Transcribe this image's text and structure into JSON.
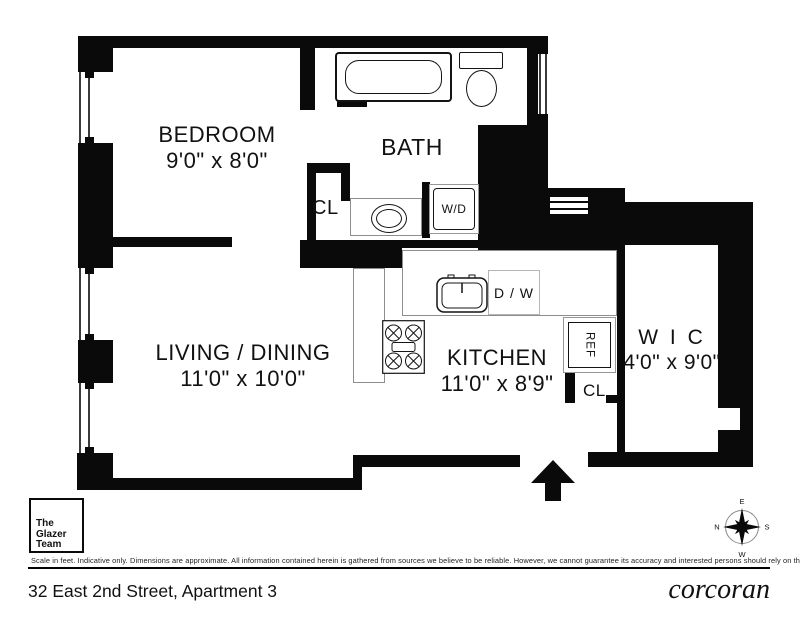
{
  "meta": {
    "address": "32 East 2nd Street, Apartment 3",
    "brand": "corcoran",
    "team": {
      "line1": "The",
      "line2": "Glazer",
      "line3": "Team"
    }
  },
  "disclaimer": "Scale in feet. Indicative only. Dimensions are approximate. All information contained herein is gathered from sources we believe to be reliable. However, we cannot guarantee its accuracy and interested persons should rely on their own enquiries.",
  "rooms": [
    {
      "id": "bedroom",
      "name": "BEDROOM",
      "dims": "9'0\" x 8'0\""
    },
    {
      "id": "bath",
      "name": "BATH",
      "dims": ""
    },
    {
      "id": "living-dining",
      "name": "LIVING / DINING",
      "dims": "11'0\" x 10'0\""
    },
    {
      "id": "kitchen",
      "name": "KITCHEN",
      "dims": "11'0\" x 8'9\""
    },
    {
      "id": "walk-in-closet",
      "name": "W I C",
      "dims": "4'0\" x 9'0\""
    },
    {
      "id": "closet-bath",
      "name": "CL"
    },
    {
      "id": "closet-entry",
      "name": "CL"
    }
  ],
  "fixtures": {
    "washer_dryer": "W/D",
    "dishwasher": "D / W",
    "refrigerator": "REF"
  },
  "compass": {
    "top": "E",
    "left": "N",
    "right": "S",
    "bottom": "W"
  }
}
